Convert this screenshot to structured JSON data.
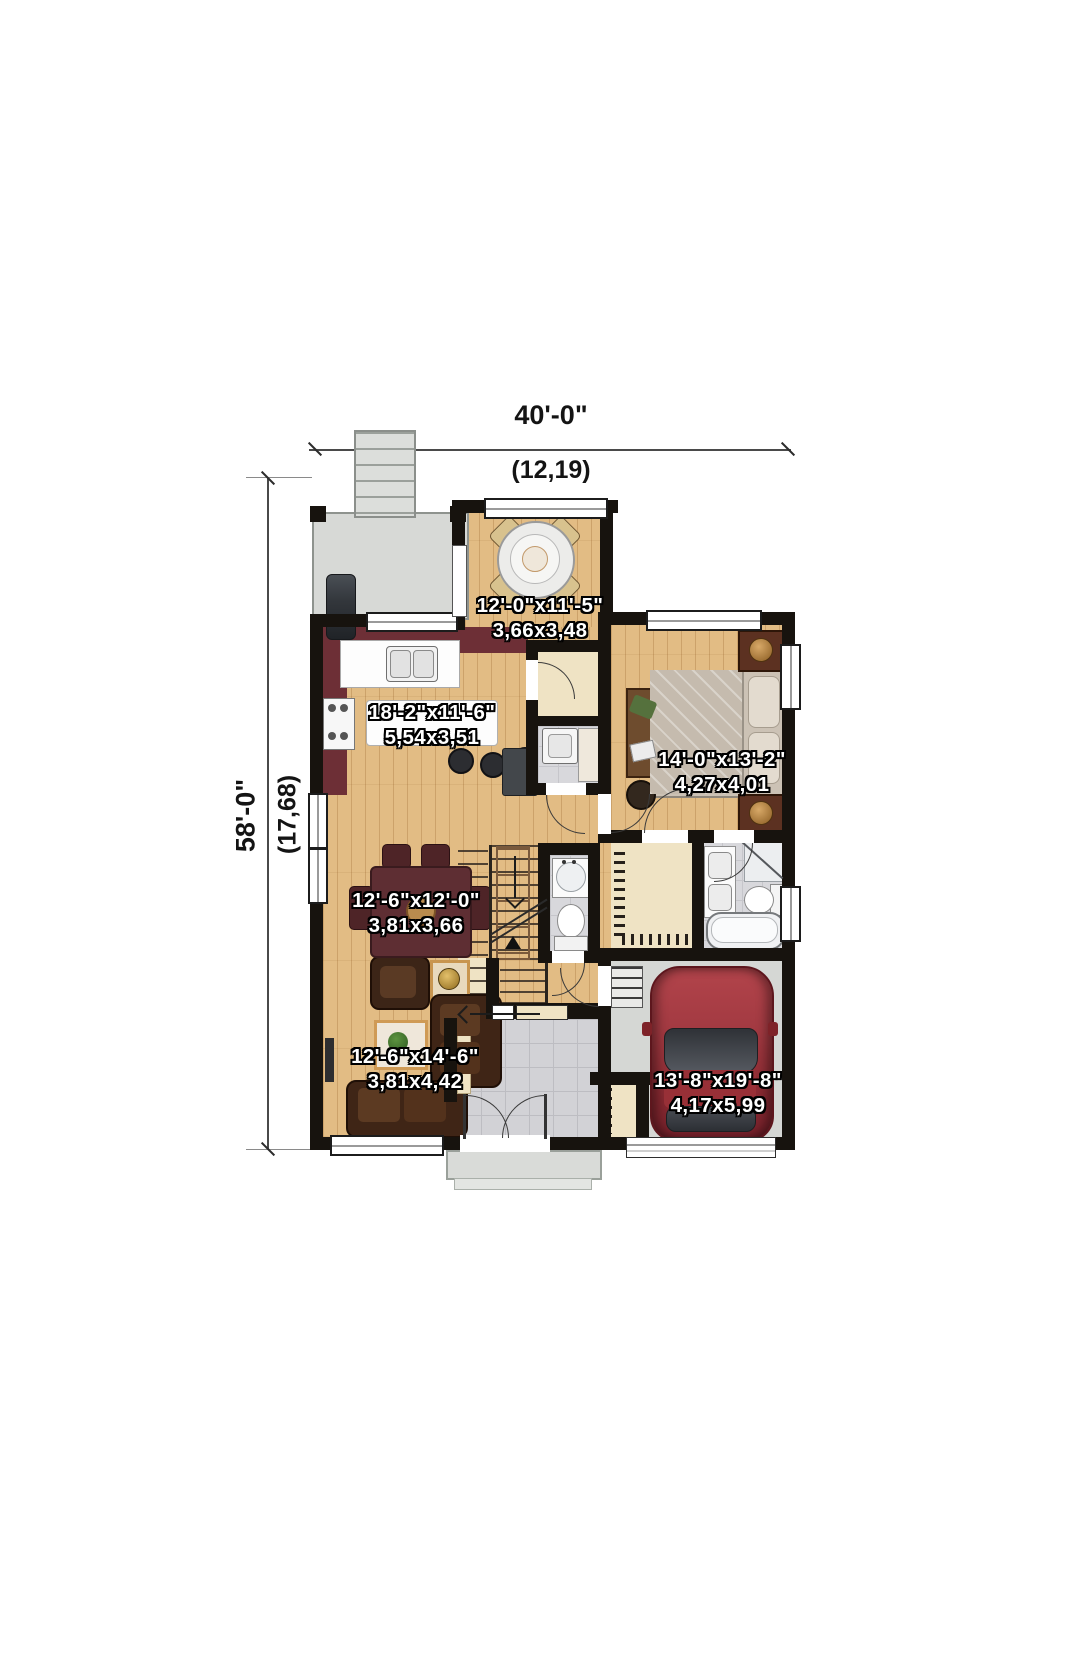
{
  "plan": {
    "type": "floor-plan",
    "overall_dimensions": {
      "width_imperial": "40'-0\"",
      "width_metric": "(12,19)",
      "depth_imperial": "58'-0\"",
      "depth_metric": "(17,68)"
    },
    "rooms": [
      {
        "id": "dinette",
        "imperial": "12'-0\"x11'-5\"",
        "metric": "3,66x3,48"
      },
      {
        "id": "kitchen",
        "imperial": "18'-2\"x11'-6\"",
        "metric": "5,54x3,51"
      },
      {
        "id": "bedroom",
        "imperial": "14'-0\"x13'-2\"",
        "metric": "4,27x4,01"
      },
      {
        "id": "dining-room",
        "imperial": "12'-6\"x12'-0\"",
        "metric": "3,81x3,66"
      },
      {
        "id": "living-room",
        "imperial": "12'-6\"x14'-6\"",
        "metric": "3,81x4,42"
      },
      {
        "id": "garage",
        "imperial": "13'-8\"x19'-8\"",
        "metric": "4,17x5,99"
      }
    ],
    "colors": {
      "wood_floor": "#e2bc84",
      "wall": "#17130e",
      "kitchen_accent": "#6d2f36",
      "deck": "#d7d9d6",
      "tile": "#d2d2d6",
      "garage_concrete": "#d5d7d4",
      "closet_beige": "#efe3c4",
      "car": "#a63a41"
    }
  }
}
